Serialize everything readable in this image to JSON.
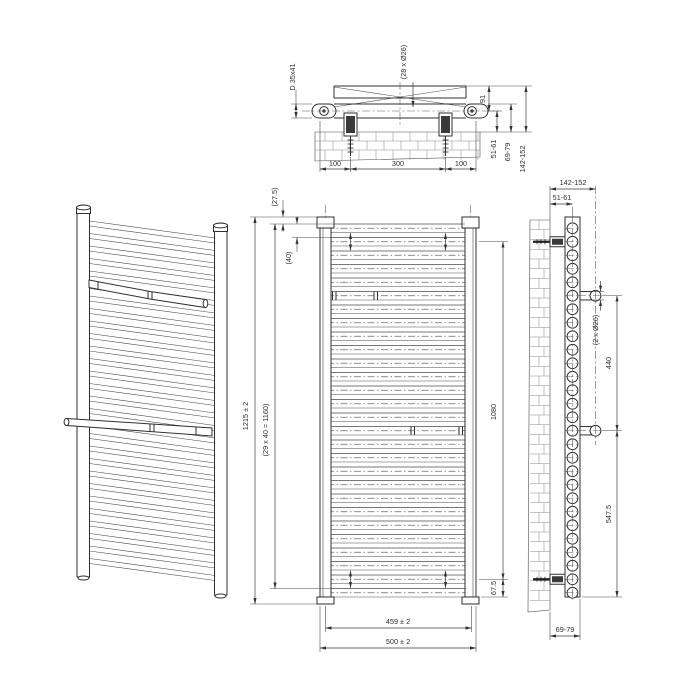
{
  "views": {
    "top": {
      "profile": "D 35x41",
      "tubes": "(28 x Ø26)",
      "depth": "91",
      "wall_to_axis": "51-61",
      "wall_to_face": "69-79",
      "wall_to_front": "142-152",
      "left_offset": "100",
      "bracket_span": "300",
      "right_offset": "100"
    },
    "front": {
      "top_margin": "(27.5)",
      "pitch": "(40)",
      "height": "1215 ± 2",
      "pitch_total": "(29 x 40 = 1160)",
      "bracket_height": "1080",
      "bottom_margin": "67.5",
      "axis_width": "459 ± 2",
      "width": "500 ± 2"
    },
    "side": {
      "wall_to_front": "142-152",
      "wall_to_axis": "51-61",
      "towel_bars": "(2 x Ø26)",
      "bar_spacing": "440",
      "bar_to_bottom": "547.5",
      "wall_to_face": "69-79"
    }
  }
}
